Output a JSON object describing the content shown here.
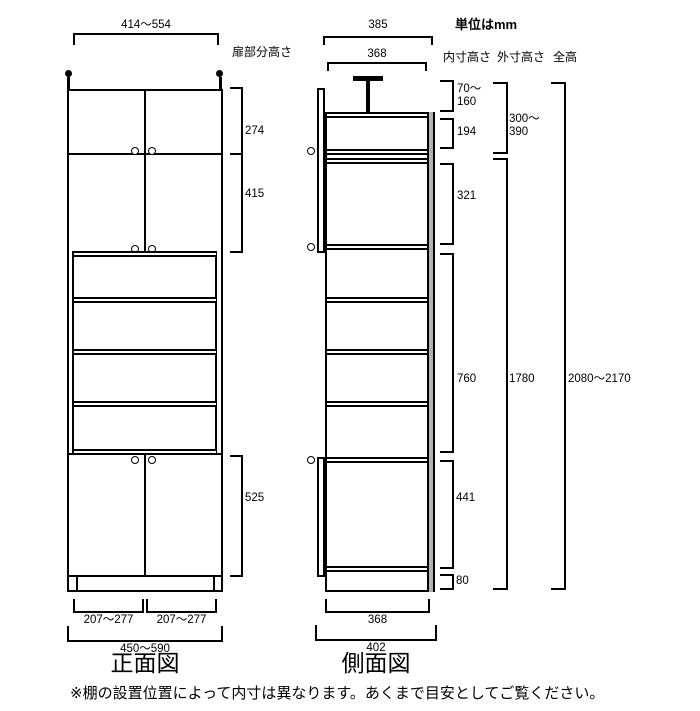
{
  "meta": {
    "unit_label": "単位はmm",
    "note": "※棚の設置位置によって内寸は異なります。あくまで目安としてご覧ください。"
  },
  "front_view": {
    "caption": "正面図",
    "top_width": "414～554",
    "door_section_label": "扉部分高さ",
    "upper_door_height": "274",
    "middle_door_height": "415",
    "lower_door_height": "525",
    "bottom_left_width": "207～277",
    "bottom_right_width": "207～277",
    "bottom_total_width": "450～590"
  },
  "side_view": {
    "caption": "側面図",
    "top_outer_depth": "385",
    "top_inner_depth": "368",
    "bottom_inner_depth": "368",
    "bottom_outer_depth": "402"
  },
  "inner_height": {
    "label": "内寸高さ",
    "top_gap_line1": "70～",
    "top_gap_line2": "160",
    "cap_section": "194",
    "upper_section": "321",
    "middle_section": "760",
    "lower_section": "441",
    "base_section": "80"
  },
  "outer_height": {
    "label": "外寸高さ",
    "cap_line1": "300～",
    "cap_line2": "390",
    "main_unit": "1780"
  },
  "total_height": {
    "label": "全高",
    "value": "2080～2170"
  },
  "colors": {
    "line": "#000000",
    "back_panel": "#b3b3b3",
    "background": "#ffffff"
  }
}
